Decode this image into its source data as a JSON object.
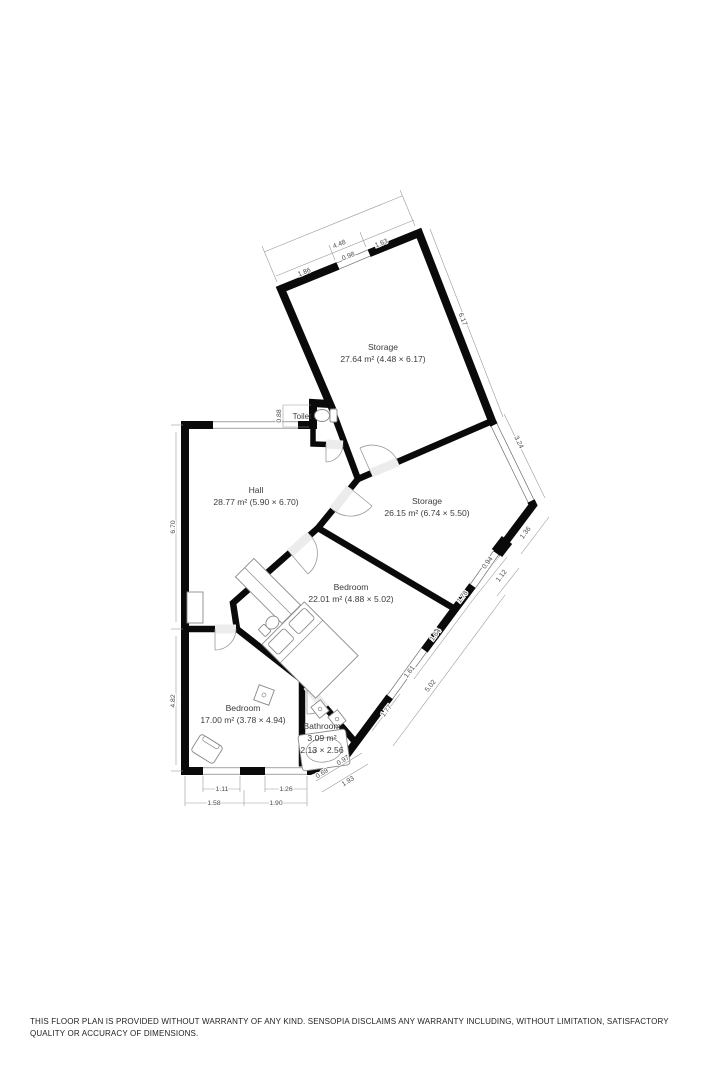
{
  "rooms": {
    "storage_top": {
      "name": "Storage",
      "area": "27.64 m² (4.48 × 6.17)"
    },
    "storage_mid": {
      "name": "Storage",
      "area": "26.15 m² (6.74 × 5.50)"
    },
    "hall": {
      "name": "Hall",
      "area": "28.77 m² (5.90 × 6.70)"
    },
    "bedroom_large": {
      "name": "Bedroom",
      "area": "22.01 m² (4.88 × 5.02)"
    },
    "bedroom_small": {
      "name": "Bedroom",
      "area": "17.00 m² (3.78 × 4.94)"
    },
    "bathroom": {
      "name": "Bathroom",
      "area_line1": "3.09 m²",
      "area_line2": "2.13 × 2.56"
    },
    "toilet": {
      "name": "Toilet"
    }
  },
  "dims": {
    "top_overall": "4.48",
    "top_seg1": "1.86",
    "top_win": "0.98",
    "top_seg2": "1.63",
    "storage_top_side": "6.17",
    "storage_mid_win": "3.24",
    "right_edge": "1.36",
    "side_094": "0.94",
    "side_112": "1.12",
    "side_178": "1.78",
    "side_164": "1.64",
    "side_161": "1.61",
    "side_total": "5.02",
    "side_win": "1.77",
    "bath_069": "0.69",
    "bath_097": "0.97",
    "bath_total": "1.93",
    "bottom_win1": "1.11",
    "bottom_win2": "1.26",
    "bottom_seg1": "1.58",
    "bottom_seg2": "1.90",
    "hall_side": "6.70",
    "bedroom_side": "4.82",
    "toilet_h": "0.88"
  },
  "colors": {
    "wall": "#0a0a0a",
    "floor": "#ececec",
    "dim_text": "#4a4a4a",
    "label_text": "#3c3c3c"
  },
  "disclaimer": "THIS FLOOR PLAN IS PROVIDED WITHOUT WARRANTY OF ANY KIND. SENSOPIA DISCLAIMS ANY WARRANTY INCLUDING, WITHOUT LIMITATION, SATISFACTORY QUALITY OR ACCURACY OF DIMENSIONS."
}
